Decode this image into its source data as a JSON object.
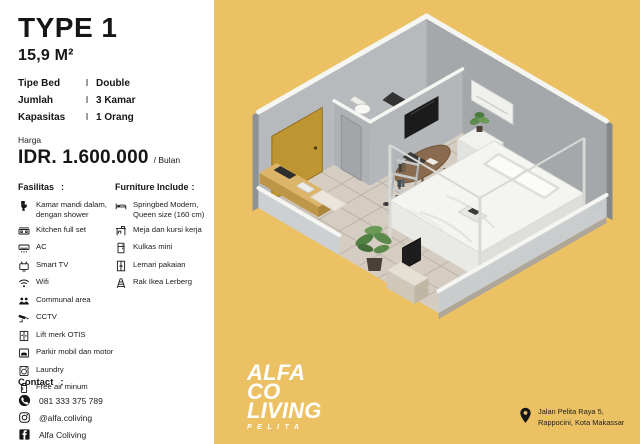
{
  "canvas": {
    "bg": "#EBC163",
    "panel_bg": "#FFFFFF"
  },
  "header": {
    "title": "TYPE 1",
    "area": "15,9 M²",
    "spec_separator": "I",
    "specs": [
      {
        "label": "Tipe Bed",
        "value": "Double"
      },
      {
        "label": "Jumlah",
        "value": "3 Kamar"
      },
      {
        "label": "Kapasitas",
        "value": "1 Orang"
      }
    ]
  },
  "price": {
    "label": "Harga",
    "amount": "IDR. 1.600.000",
    "per": "/ Bulan"
  },
  "facilities": {
    "title": "Fasilitas",
    "colon": ":",
    "items": [
      {
        "icon": "toilet-icon",
        "label": "Kamar mandi dalam, dengan shower"
      },
      {
        "icon": "kitchen-icon",
        "label": "Kitchen full set"
      },
      {
        "icon": "ac-icon",
        "label": "AC"
      },
      {
        "icon": "tv-icon",
        "label": "Smart TV"
      },
      {
        "icon": "wifi-icon",
        "label": "Wifi"
      },
      {
        "icon": "people-icon",
        "label": "Communal area"
      },
      {
        "icon": "cctv-icon",
        "label": "CCTV"
      },
      {
        "icon": "elevator-icon",
        "label": "Lift merk OTIS"
      },
      {
        "icon": "parking-icon",
        "label": "Parkir mobil dan motor"
      },
      {
        "icon": "laundry-icon",
        "label": "Laundry"
      },
      {
        "icon": "water-icon",
        "label": "Free air minum"
      }
    ]
  },
  "furniture": {
    "title": "Furniture Include",
    "colon": ":",
    "items": [
      {
        "icon": "bed-icon",
        "label": "Springbed Modern, Queen size (160 cm)"
      },
      {
        "icon": "desk-icon",
        "label": "Meja dan kursi kerja"
      },
      {
        "icon": "fridge-icon",
        "label": "Kulkas mini"
      },
      {
        "icon": "wardrobe-icon",
        "label": "Lemari pakaian"
      },
      {
        "icon": "shelf-icon",
        "label": "Rak Ikea Lerberg"
      }
    ]
  },
  "contact": {
    "title": "Contact",
    "colon": ":",
    "items": [
      {
        "icon": "phone-icon",
        "label": "081 333 375 789"
      },
      {
        "icon": "instagram-icon",
        "label": "@alfa.coliving"
      },
      {
        "icon": "facebook-icon",
        "label": "Alfa Coliving"
      }
    ]
  },
  "brand": {
    "line1": "ALFA",
    "line2": "CO",
    "line3": "LIVING",
    "sub": "PELITA"
  },
  "address": {
    "line1": "Jalan Pelita Raya 5,",
    "line2": "Rappocini, Kota Makassar"
  },
  "room_colors": {
    "wall": "#A9ADB0",
    "wall_cap": "#F5F5F2",
    "floor": "#D6CDC2",
    "door": "#BE9530",
    "bed": "#F4F4F1",
    "plant": "#5C8A4A"
  }
}
